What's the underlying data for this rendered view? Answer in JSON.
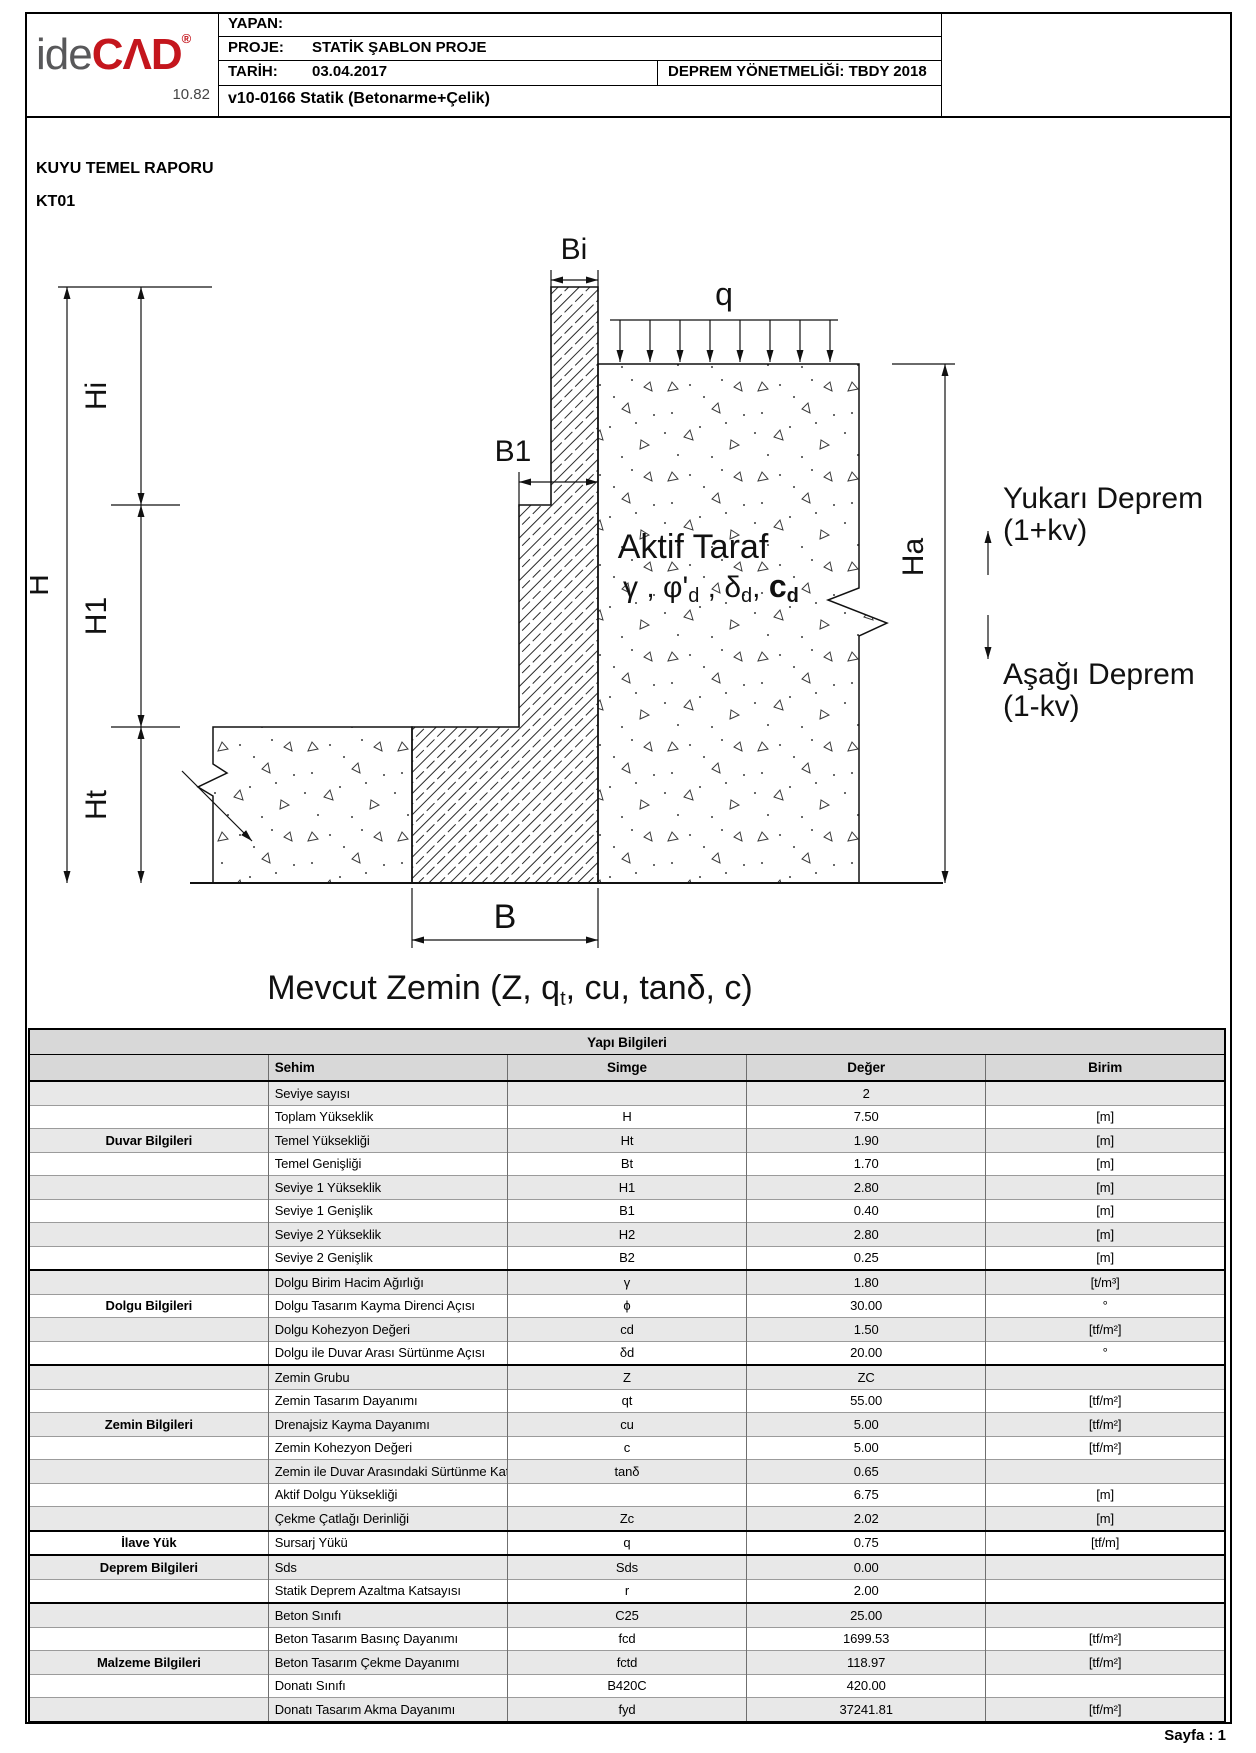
{
  "header": {
    "yapan_label": "YAPAN:",
    "proje_label": "PROJE:",
    "proje_value": "STATİK ŞABLON PROJE",
    "tarih_label": "TARİH:",
    "tarih_value": "03.04.2017",
    "deprem_code": "DEPREM YÖNETMELİĞİ: TBDY 2018",
    "version_line": "v10-0166 Statik (Betonarme+Çelik)",
    "logo": {
      "ide": "ide",
      "cad": "CΛD",
      "reg": "®",
      "version": "10.82"
    },
    "logo_colors": {
      "grey": "#58585a",
      "red": "#c4161d"
    }
  },
  "titles": {
    "report": "KUYU TEMEL RAPORU",
    "code": "KT01"
  },
  "diagram": {
    "bi": "Bi",
    "b1": "B1",
    "b": "B",
    "q": "q",
    "hi": "Hi",
    "h1": "H1",
    "ht": "Ht",
    "h": "H",
    "ha": "Ha",
    "aktif_line1": "Aktif Taraf",
    "aktif_s1": "γ , φ'",
    "aktif_s2": "d",
    "aktif_s3": " , δ",
    "aktif_s4": "d",
    "aktif_s5": ", ",
    "aktif_s6": "c",
    "aktif_s7": "d",
    "yukari1": "Yukarı Deprem",
    "yukari2": "(1+kv)",
    "asagi1": "Aşağı Deprem",
    "asagi2": "(1-kv)",
    "mevcut1": "Mevcut Zemin  (Z, q",
    "mevcut2": "t",
    "mevcut3": ", cu, tanδ, c)"
  },
  "table": {
    "title": "Yapı Bilgileri",
    "columns": [
      "",
      "Sehim",
      "Simge",
      "Değer",
      "Birim"
    ],
    "rows": [
      {
        "group": "",
        "sehim": "Seviye sayısı",
        "simge": "",
        "deger": "2",
        "birim": "",
        "sep": false
      },
      {
        "group": "",
        "sehim": "Toplam Yükseklik",
        "simge": "H",
        "deger": "7.50",
        "birim": "[m]",
        "sep": false
      },
      {
        "group": "Duvar Bilgileri",
        "sehim": "Temel Yüksekliği",
        "simge": "Ht",
        "deger": "1.90",
        "birim": "[m]",
        "sep": false
      },
      {
        "group": "",
        "sehim": "Temel Genişliği",
        "simge": "Bt",
        "deger": "1.70",
        "birim": "[m]",
        "sep": false
      },
      {
        "group": "",
        "sehim": "Seviye 1 Yükseklik",
        "simge": "H1",
        "deger": "2.80",
        "birim": "[m]",
        "sep": false
      },
      {
        "group": "",
        "sehim": "Seviye 1 Genişlik",
        "simge": "B1",
        "deger": "0.40",
        "birim": "[m]",
        "sep": false
      },
      {
        "group": "",
        "sehim": "Seviye 2 Yükseklik",
        "simge": "H2",
        "deger": "2.80",
        "birim": "[m]",
        "sep": false
      },
      {
        "group": "",
        "sehim": "Seviye 2 Genişlik",
        "simge": "B2",
        "deger": "0.25",
        "birim": "[m]",
        "sep": false
      },
      {
        "group": "",
        "sehim": "Dolgu Birim Hacim Ağırlığı",
        "simge": "γ",
        "deger": "1.80",
        "birim": "[t/m³]",
        "sep": true
      },
      {
        "group": "Dolgu Bilgileri",
        "sehim": "Dolgu Tasarım Kayma Direnci Açısı",
        "simge": "ϕ",
        "deger": "30.00",
        "birim": "°",
        "sep": false
      },
      {
        "group": "",
        "sehim": "Dolgu Kohezyon Değeri",
        "simge": "cd",
        "deger": "1.50",
        "birim": "[tf/m²]",
        "sep": false
      },
      {
        "group": "",
        "sehim": "Dolgu ile Duvar Arası Sürtünme Açısı",
        "simge": "δd",
        "deger": "20.00",
        "birim": "°",
        "sep": false
      },
      {
        "group": "",
        "sehim": "Zemin Grubu",
        "simge": "Z",
        "deger": "ZC",
        "birim": "",
        "sep": true
      },
      {
        "group": "",
        "sehim": "Zemin Tasarım Dayanımı",
        "simge": "qt",
        "deger": "55.00",
        "birim": "[tf/m²]",
        "sep": false
      },
      {
        "group": "Zemin Bilgileri",
        "sehim": "Drenajsiz Kayma Dayanımı",
        "simge": "cu",
        "deger": "5.00",
        "birim": "[tf/m²]",
        "sep": false
      },
      {
        "group": "",
        "sehim": "Zemin Kohezyon Değeri",
        "simge": "c",
        "deger": "5.00",
        "birim": "[tf/m²]",
        "sep": false
      },
      {
        "group": "",
        "sehim": "Zemin ile Duvar Arasındaki Sürtünme Katsayısı",
        "simge": "tanδ",
        "deger": "0.65",
        "birim": "",
        "sep": false
      },
      {
        "group": "",
        "sehim": "Aktif Dolgu Yüksekliği",
        "simge": "",
        "deger": "6.75",
        "birim": "[m]",
        "sep": false
      },
      {
        "group": "",
        "sehim": "Çekme Çatlağı Derinliği",
        "simge": "Zc",
        "deger": "2.02",
        "birim": "[m]",
        "sep": false
      },
      {
        "group": "İlave Yük",
        "sehim": "Sursarj Yükü",
        "simge": "q",
        "deger": "0.75",
        "birim": "[tf/m]",
        "sep": true
      },
      {
        "group": "Deprem Bilgileri",
        "sehim": "Sds",
        "simge": "Sds",
        "deger": "0.00",
        "birim": "",
        "sep": true
      },
      {
        "group": "",
        "sehim": "Statik Deprem Azaltma Katsayısı",
        "simge": "r",
        "deger": "2.00",
        "birim": "",
        "sep": false
      },
      {
        "group": "",
        "sehim": "Beton Sınıfı",
        "simge": "C25",
        "deger": "25.00",
        "birim": "",
        "sep": true
      },
      {
        "group": "",
        "sehim": "Beton Tasarım Basınç Dayanımı",
        "simge": "fcd",
        "deger": "1699.53",
        "birim": "[tf/m²]",
        "sep": false
      },
      {
        "group": "Malzeme Bilgileri",
        "sehim": "Beton Tasarım Çekme Dayanımı",
        "simge": "fctd",
        "deger": "118.97",
        "birim": "[tf/m²]",
        "sep": false
      },
      {
        "group": "",
        "sehim": "Donatı Sınıfı",
        "simge": "B420C",
        "deger": "420.00",
        "birim": "",
        "sep": false
      },
      {
        "group": "",
        "sehim": "Donatı Tasarım Akma Dayanımı",
        "simge": "fyd",
        "deger": "37241.81",
        "birim": "[tf/m²]",
        "sep": false
      }
    ]
  },
  "footer": {
    "page": "Sayfa : 1"
  }
}
